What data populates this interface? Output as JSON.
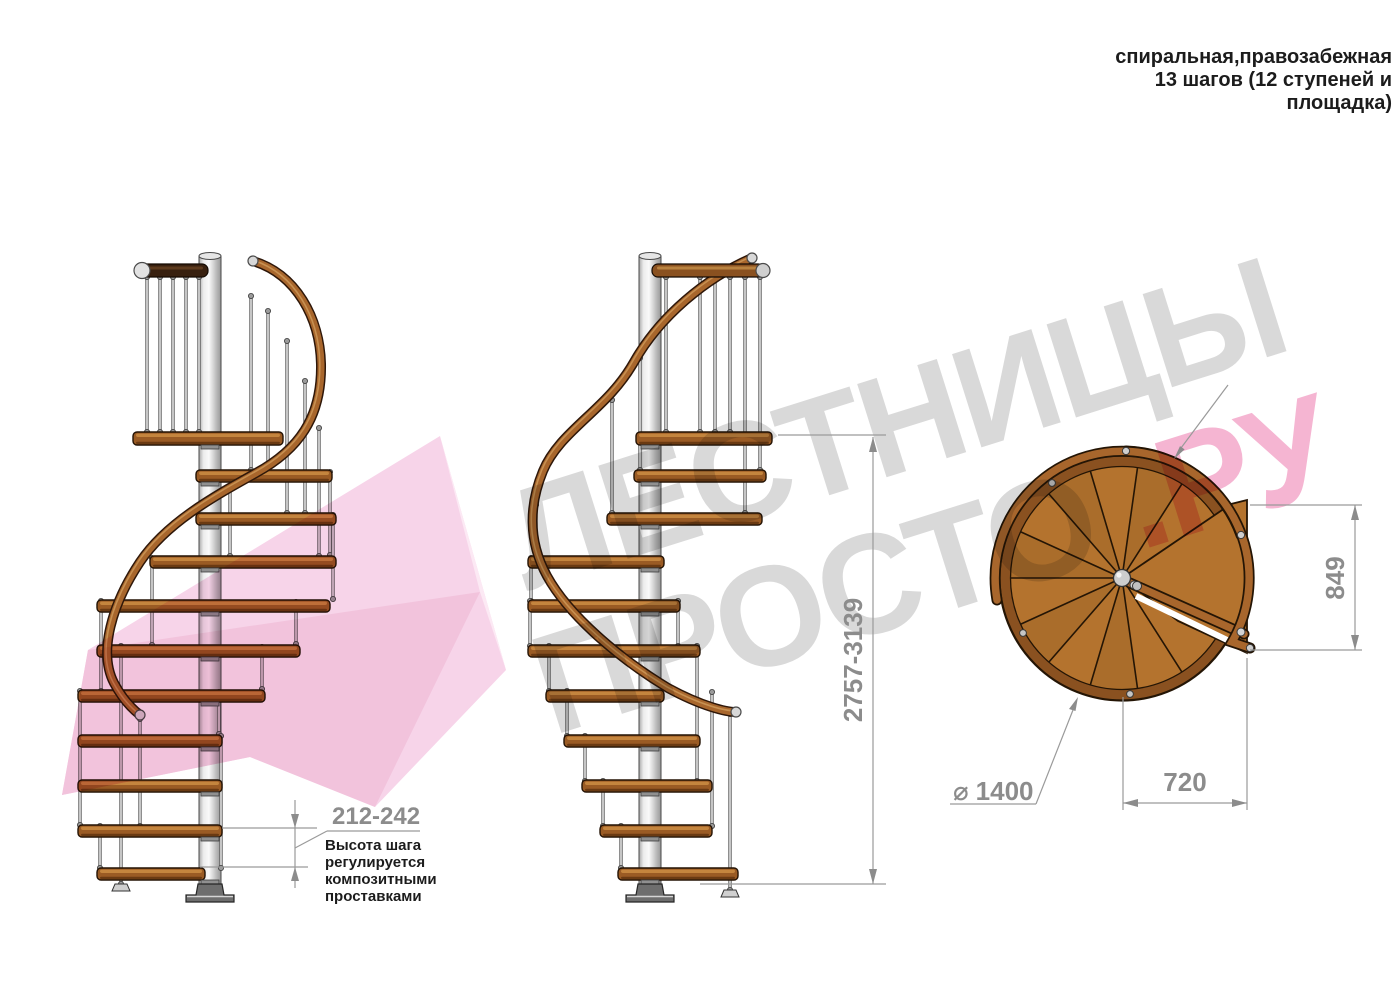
{
  "title": {
    "line1": "спиральная,правозабежная",
    "line2": "13 шагов (12 ступеней и",
    "line3": "площадка)"
  },
  "watermark": {
    "word1": "ЛЕСТНИЦЫ",
    "word2": "ПРОСТО",
    "suffix": ".РУ"
  },
  "note": {
    "line1": "Высота шага",
    "line2": "регулируется",
    "line3": "композитными",
    "line4": "проставками"
  },
  "dimensions": {
    "step_height": "212-242",
    "total_height": "2757-3139",
    "platform_depth": "849",
    "platform_width": "720",
    "diameter_symbol": "⌀",
    "diameter_value": "1400"
  },
  "colors": {
    "wood": "#b4732e",
    "wood_rim": "#8a5120",
    "rail_brown": "#a8662c",
    "metal_light": "#d9d9d9",
    "dim_gray": "#8c8c8c",
    "watermark_gray": "#d9d9d9",
    "watermark_pink": "#f5b5d2",
    "pink_shape": "#f7d4e9",
    "text_black": "#1c1c1c"
  }
}
